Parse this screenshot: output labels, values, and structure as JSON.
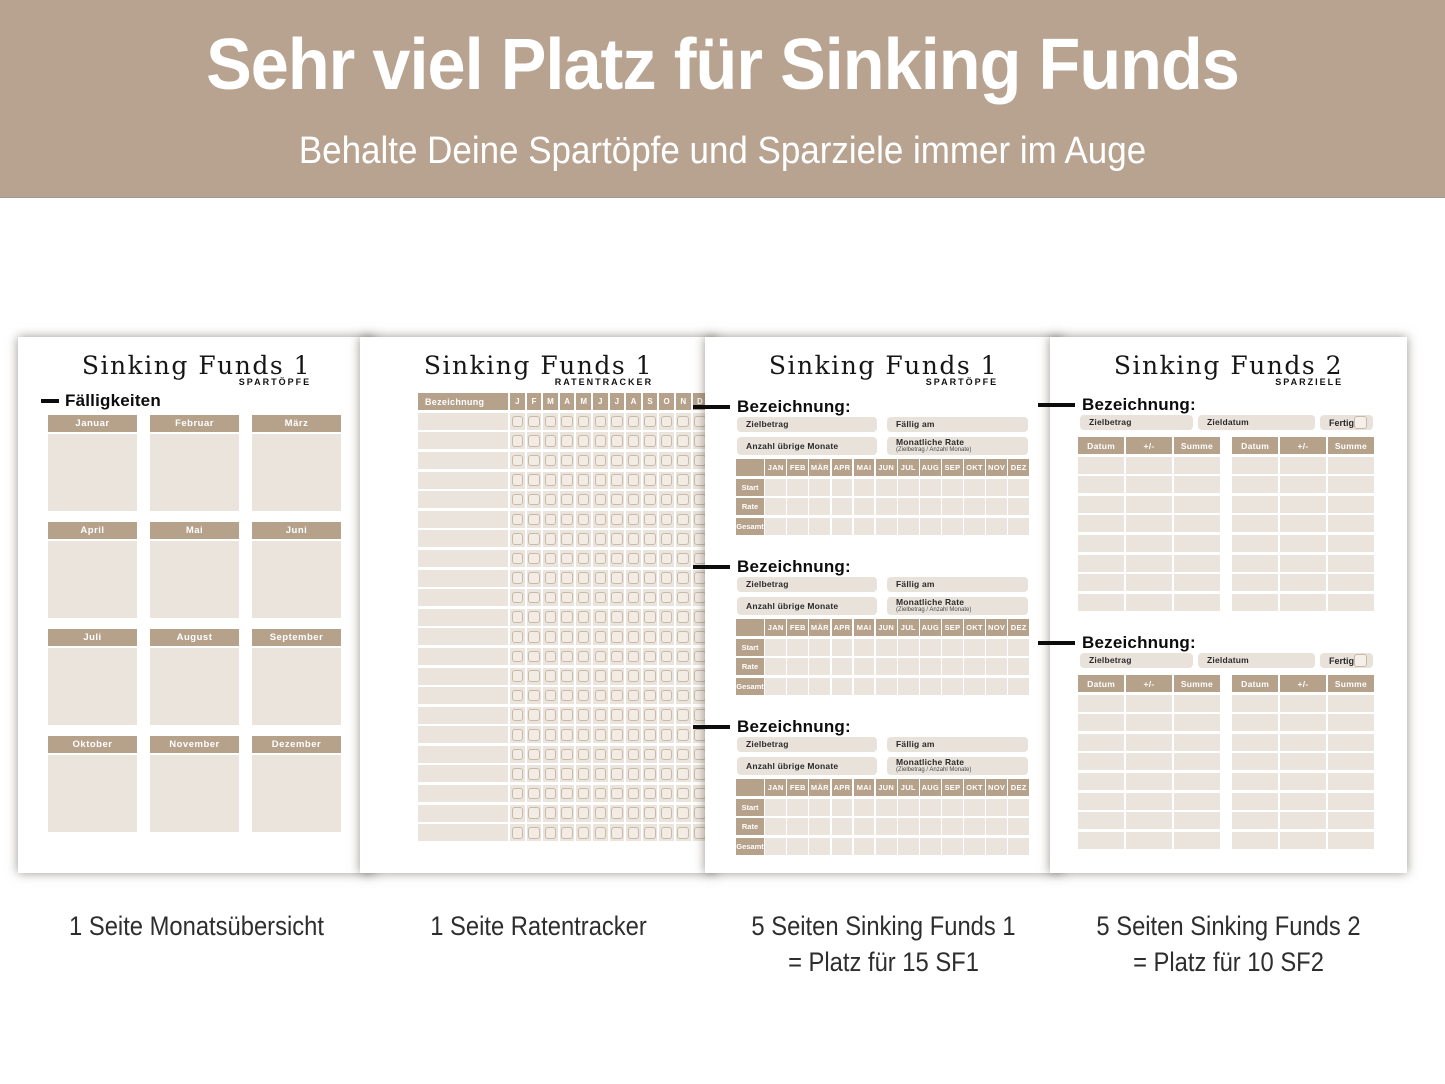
{
  "banner": {
    "title": "Sehr viel Platz für Sinking Funds",
    "subtitle": "Behalte Deine Spartöpfe und Sparziele immer im Auge"
  },
  "colors": {
    "banner_bg": "#b8a390",
    "tan": "#b6a18b",
    "light_cell": "#eae4dc",
    "field_box": "#e9e2da",
    "checkbox_border": "#c9baa8",
    "page_bg": "#ffffff",
    "ink": "#0c0c0c"
  },
  "pages": {
    "monatsuebersicht": {
      "title": "Sinking Funds 1",
      "tag": "SPARTÖPFE",
      "heading": "Fälligkeiten",
      "months": [
        "Januar",
        "Februar",
        "März",
        "April",
        "Mai",
        "Juni",
        "Juli",
        "August",
        "September",
        "Oktober",
        "November",
        "Dezember"
      ],
      "caption": "1 Seite Monatsübersicht"
    },
    "ratentracker": {
      "title": "Sinking Funds 1",
      "tag": "RATENTRACKER",
      "col_header": "Bezeichnung",
      "month_letters": [
        "J",
        "F",
        "M",
        "A",
        "M",
        "J",
        "J",
        "A",
        "S",
        "O",
        "N",
        "D"
      ],
      "row_count": 22,
      "caption": "1 Seite Ratentracker"
    },
    "sf1": {
      "title": "Sinking Funds 1",
      "tag": "SPARTÖPFE",
      "block_count": 3,
      "block": {
        "heading": "Bezeichnung:",
        "field_zielbetrag": "Zielbetrag",
        "field_faellig": "Fällig am",
        "field_monate": "Anzahl übrige Monate",
        "field_rate": "Monatliche Rate",
        "field_rate_note": "(Zielbetrag / Anzahl Monate)",
        "months": [
          "JAN",
          "FEB",
          "MÄR",
          "APR",
          "MAI",
          "JUN",
          "JUL",
          "AUG",
          "SEP",
          "OKT",
          "NOV",
          "DEZ"
        ],
        "row_labels": [
          "Start",
          "Rate",
          "Gesamt"
        ]
      },
      "caption_line1": "5 Seiten Sinking Funds 1",
      "caption_line2": "= Platz für 15 SF1"
    },
    "sf2": {
      "title": "Sinking Funds 2",
      "tag": "SPARZIELE",
      "block_count": 2,
      "block": {
        "heading": "Bezeichnung:",
        "field_zielbetrag": "Zielbetrag",
        "field_zieldatum": "Zieldatum",
        "field_fertig": "Fertig",
        "table_headers": [
          "Datum",
          "+/-",
          "Summe"
        ],
        "tables_per_block": 2,
        "row_count": 8
      },
      "caption_line1": "5 Seiten Sinking Funds 2",
      "caption_line2": "= Platz für 10 SF2"
    }
  }
}
